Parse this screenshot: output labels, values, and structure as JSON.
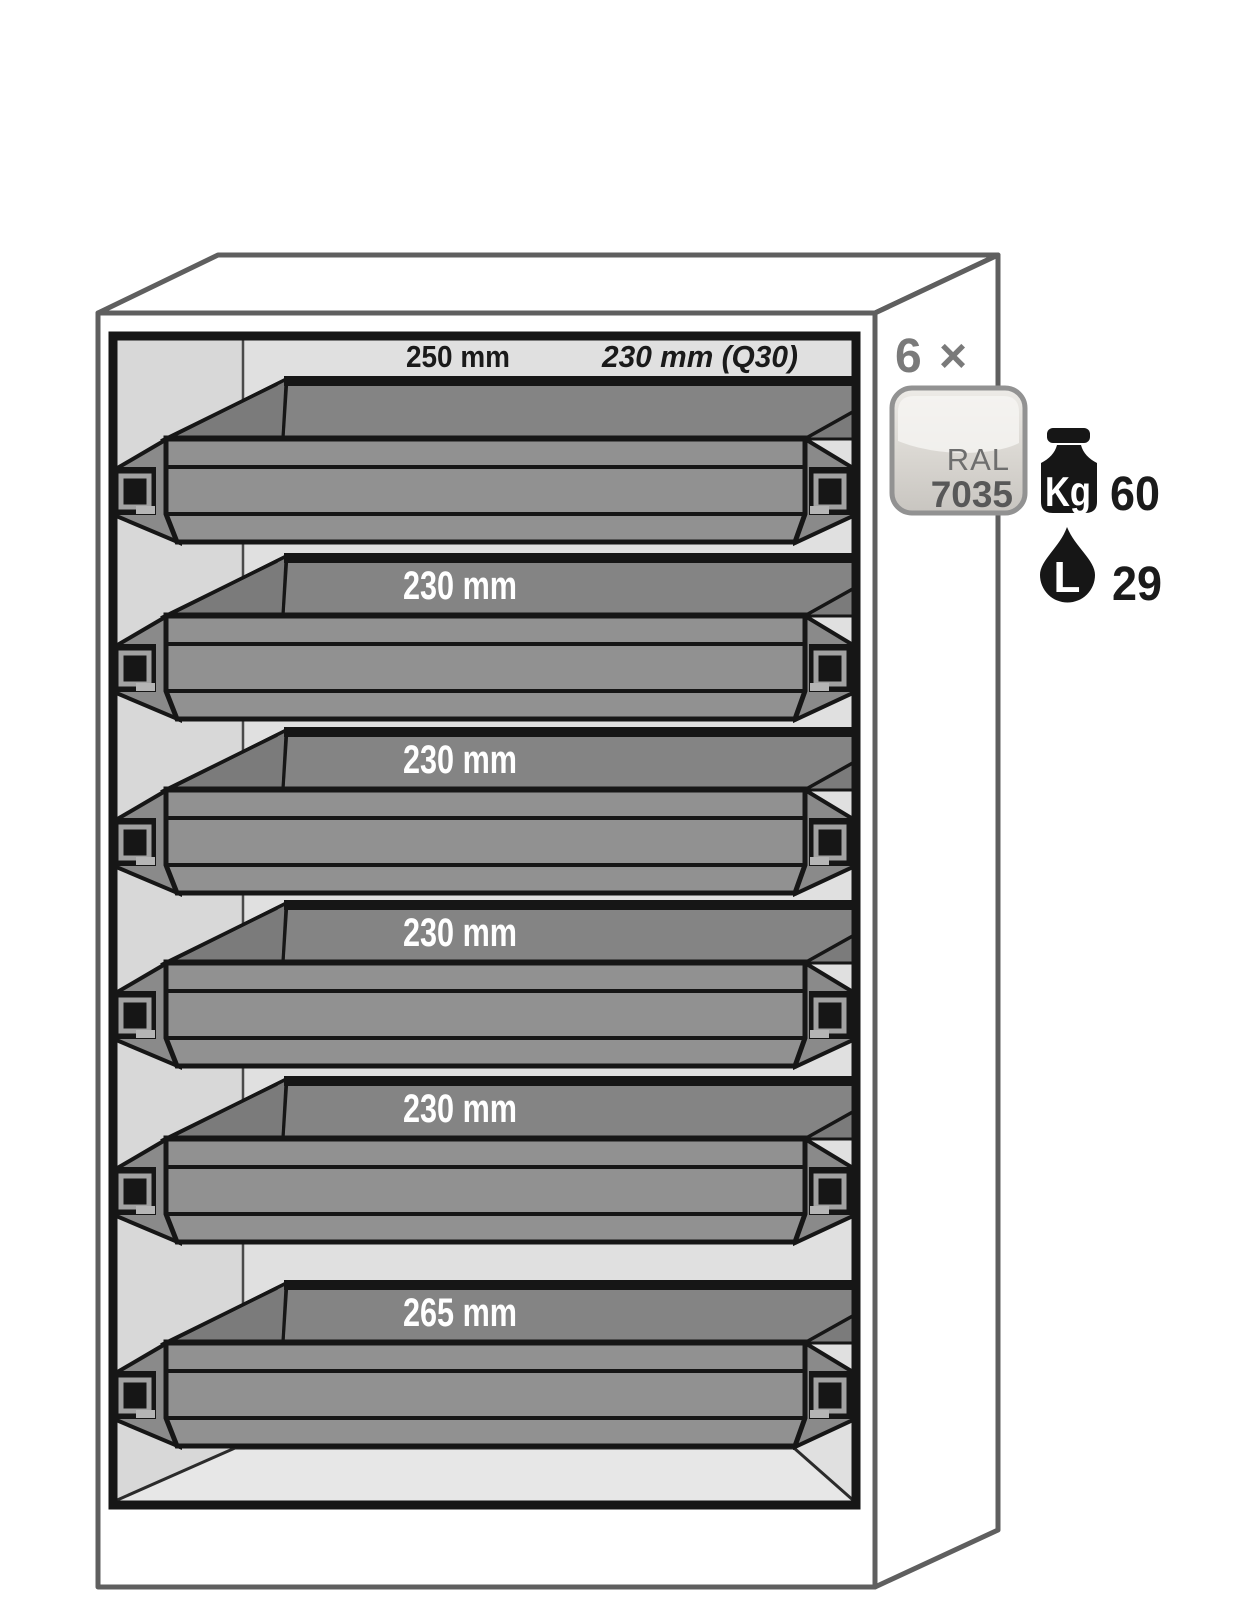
{
  "diagram_title": "safety-cabinet-6-drawer-diagram",
  "cabinet": {
    "header": {
      "front_label": "250 mm",
      "alt_label": "230 mm (Q30)"
    },
    "drawers": [
      {
        "label": ""
      },
      {
        "label": "230 mm"
      },
      {
        "label": "230 mm"
      },
      {
        "label": "230 mm"
      },
      {
        "label": "230 mm"
      },
      {
        "label": "265 mm"
      }
    ]
  },
  "legend": {
    "quantity": "6 ×",
    "ral_swatch": {
      "line1": "RAL",
      "line2": "7035"
    },
    "load": {
      "icon": "kg-weight-icon",
      "unit_label": "Kg",
      "value": "60"
    },
    "volume": {
      "icon": "liter-drop-icon",
      "unit_label": "L",
      "value": "29"
    }
  },
  "colors": {
    "tray_gray": "#8a8a8a",
    "tray_top_gray": "#848484",
    "interior_gray": "#e0e0e0",
    "outline_gray": "#5f5f5f",
    "ink_black": "#161616",
    "label_white": "#ffffff",
    "quantity_gray": "#7a7a7a",
    "ral_fill": "#d9d6d1"
  }
}
